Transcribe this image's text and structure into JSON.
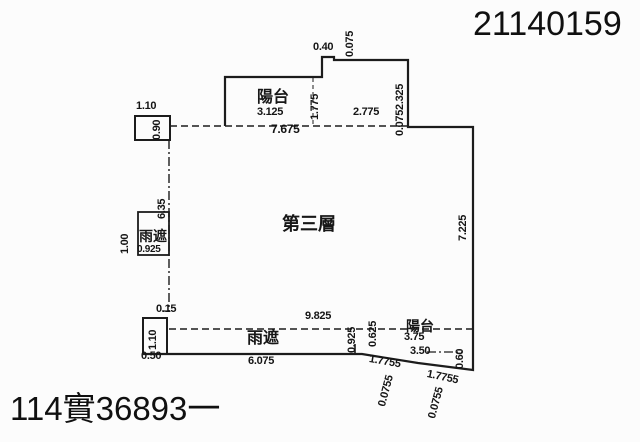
{
  "header": {
    "serial_top_right": "21140159"
  },
  "footer": {
    "serial_bottom_left": "114實36893一"
  },
  "plan": {
    "floor_label": "第三層",
    "labels": {
      "balcony_top": "陽台",
      "balcony_bottom": "陽台",
      "rain_shelter_left": "雨遮",
      "rain_shelter_bottom": "雨遮"
    },
    "dims": {
      "top_box_width": "1.10",
      "top_box_height": "0.90",
      "balcony_top_width": "3.125",
      "balcony_top_height": "1.775",
      "notch_width": "0.40",
      "notch_height": "0.075",
      "top_right_width": "2.775",
      "top_right_height": "2.325",
      "top_right_offset": "0.075",
      "top_total_width": "7.675",
      "left_side_height": "6.35",
      "left_shelter_width": "0.925",
      "left_shelter_height": "1.00",
      "right_side_height": "7.225",
      "left_gap": "0.15",
      "bottom_left_box_height": "1.10",
      "bottom_left_box_width": "0.50",
      "bottom_shelter_width": "6.075",
      "bottom_total_width": "9.825",
      "bottom_shelter_height": "0.925",
      "balcony_bottom_height": "0.625",
      "balcony_bottom_width_inner": "3.75",
      "balcony_bottom_width_outer": "3.50",
      "balcony_bottom_right_height": "0.60",
      "slope_left_length": "1.7755",
      "slope_left_offset": "0.0755",
      "slope_right_length": "1.7755",
      "slope_right_offset": "0.0755"
    }
  }
}
